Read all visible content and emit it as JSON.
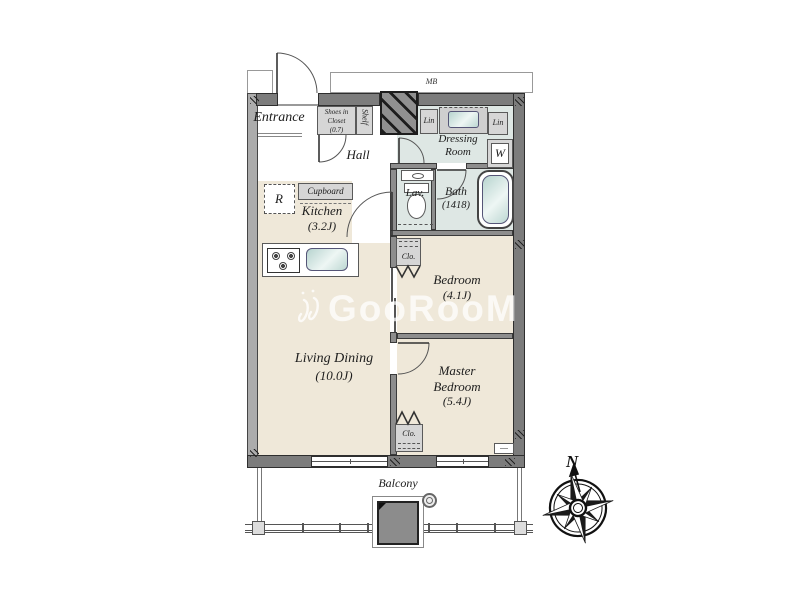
{
  "plan": {
    "watermark": "GooRooM",
    "compass": {
      "north": "N"
    },
    "corridor": {
      "meter_box": "MB"
    },
    "rooms": {
      "entrance": {
        "label": "Entrance"
      },
      "hall": {
        "label": "Hall"
      },
      "kitchen": {
        "label": "Kitchen",
        "size": "(3.2J)"
      },
      "living_dining": {
        "label": "Living Dining",
        "size": "(10.0J)"
      },
      "bedroom": {
        "label": "Bedroom",
        "size": "(4.1J)"
      },
      "master_bedroom": {
        "label1": "Master",
        "label2": "Bedroom",
        "size": "(5.4J)"
      },
      "bath": {
        "label": "Bath",
        "size": "(1418)"
      },
      "lavatory": {
        "label": "Lav."
      },
      "dressing_room": {
        "label1": "Dressing",
        "label2": "Room"
      },
      "balcony": {
        "label": "Balcony"
      }
    },
    "storage": {
      "shoes_closet": {
        "line1": "Shoes in",
        "line2": "Closet",
        "line3": "(0.7)"
      },
      "shelf": {
        "label": "Shelf"
      },
      "linen_left": {
        "label": "Lin"
      },
      "linen_right": {
        "label": "Lin"
      },
      "washer": {
        "label": "W"
      },
      "cupboard": {
        "label": "Cupboard"
      },
      "refrigerator": {
        "label": "R"
      },
      "closet_bedroom": {
        "label": "Clo."
      },
      "closet_master": {
        "label": "Clo."
      }
    },
    "colors": {
      "room_floor": "#EFE8D9",
      "wet_floor": "#DEE7E4",
      "storage_fill": "#D6D6D6",
      "wall": "#7C7C7C",
      "outline": "#2E2E2E",
      "fixture_teal": "#BFD9D4"
    }
  }
}
